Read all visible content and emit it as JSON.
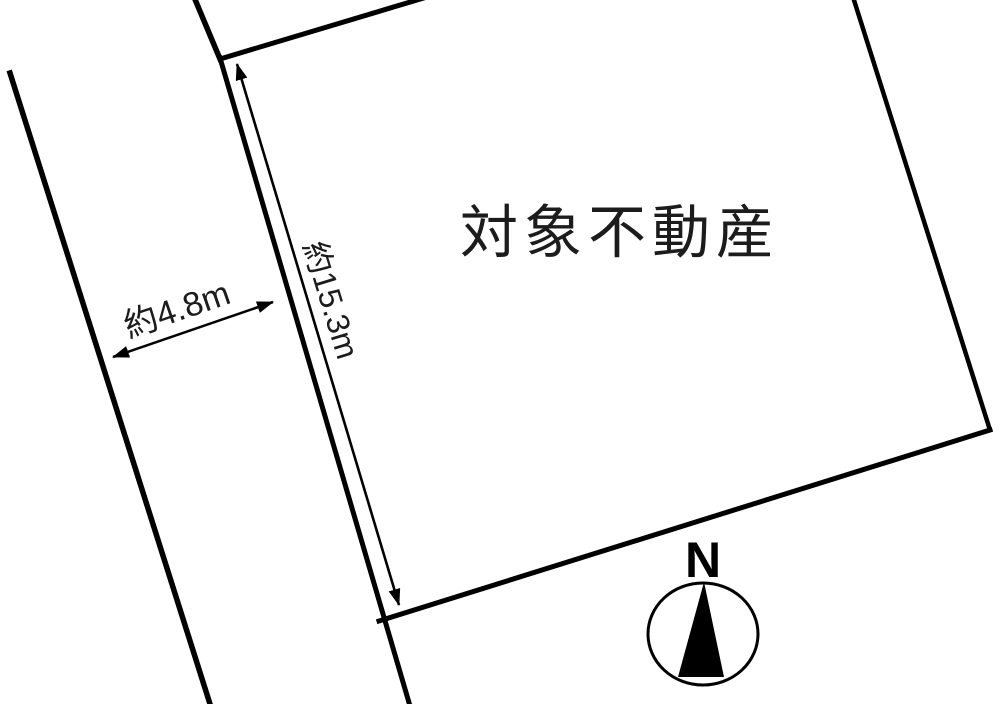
{
  "diagram": {
    "property_label": "対象不動産",
    "dimensions": {
      "road_width": "約4.8m",
      "frontage_depth": "約15.3m"
    },
    "compass": {
      "north_label": "N"
    },
    "colors": {
      "line": "#000000",
      "text": "#1c1c1c",
      "background": "#ffffff"
    }
  }
}
